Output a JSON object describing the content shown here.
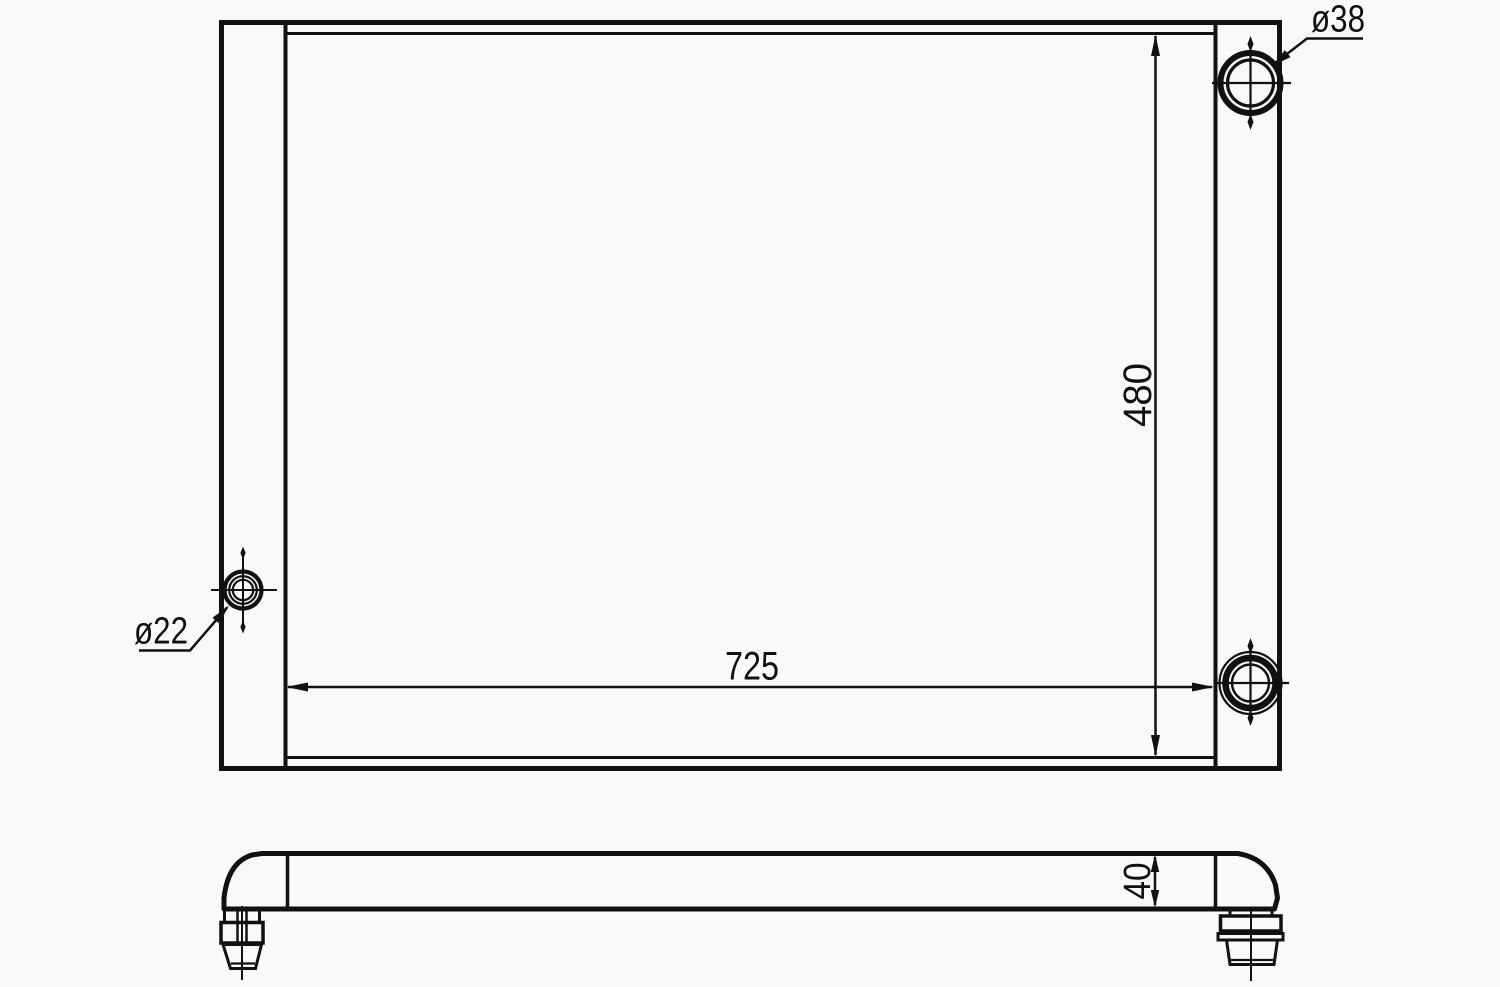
{
  "diagram": {
    "type": "technical-drawing",
    "labels": {
      "width": "725",
      "height": "480",
      "thickness": "40",
      "top_port": "ø38",
      "side_port": "ø22"
    },
    "colors": {
      "line": "#111111",
      "background": "#f9f9f9"
    }
  }
}
